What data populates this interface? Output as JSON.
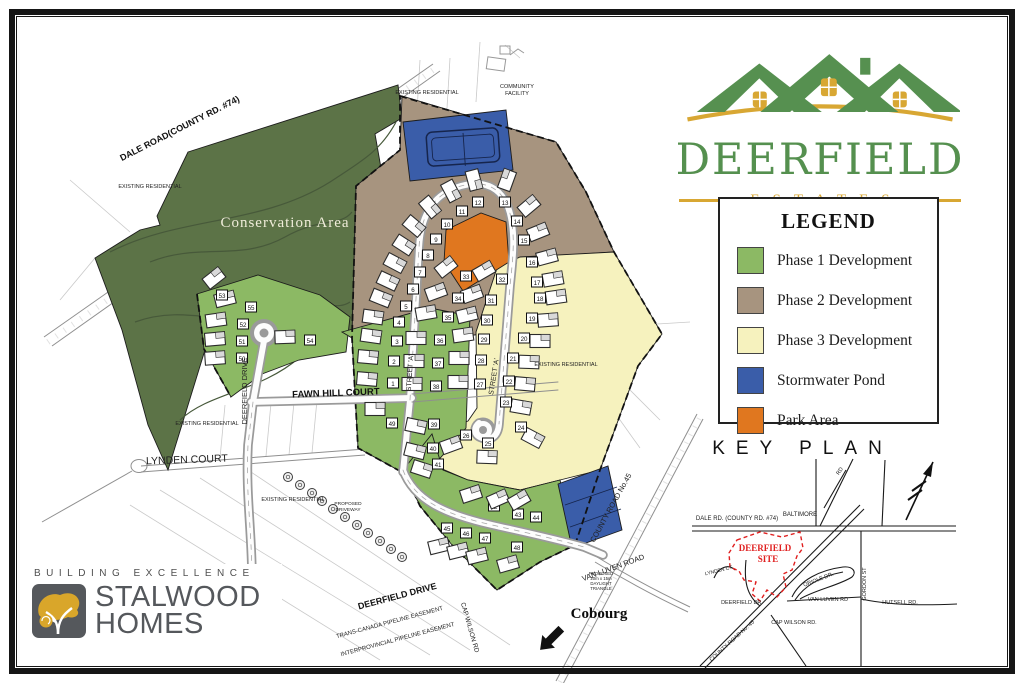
{
  "branding": {
    "name": "DEERFIELD",
    "tagline": "ESTATES"
  },
  "legend": {
    "title": "LEGEND",
    "items": [
      {
        "label": "Phase 1 Development",
        "color": "#8CB964"
      },
      {
        "label": "Phase 2 Development",
        "color": "#A7947F"
      },
      {
        "label": "Phase 3 Development",
        "color": "#F6F2BE"
      },
      {
        "label": "Stormwater Pond",
        "color": "#3A5DA9"
      },
      {
        "label": "Park Area",
        "color": "#E0771F"
      }
    ]
  },
  "key_plan": {
    "title": "KEY PLAN",
    "labels": [
      [
        "DALE RD. (COUNTY RD. #74)",
        737,
        520,
        0,
        6,
        "lbl"
      ],
      [
        "BALTIMORE",
        800,
        516,
        0,
        6,
        "lbl"
      ],
      [
        "RD",
        841,
        472,
        -55,
        5.5,
        "lbl"
      ],
      [
        "DEERFIELD",
        765,
        551,
        0,
        9,
        "red"
      ],
      [
        "SITE",
        768,
        562,
        0,
        9,
        "red"
      ],
      [
        "LYNDEN CT",
        719,
        572,
        -14,
        5,
        "lbl"
      ],
      [
        "DEERFIELD DR.",
        742,
        604,
        0,
        5.5,
        "lbl"
      ],
      [
        "COUNTY ROAD No. 45",
        733,
        642,
        -42,
        5.5,
        "lbl"
      ],
      [
        "CAP WILSON RD.",
        794,
        624,
        0,
        5.5,
        "lbl"
      ],
      [
        "VAN LUVEN  RD",
        828,
        601,
        0,
        5.5,
        "lbl"
      ],
      [
        "ORIOLE DR.",
        819,
        581,
        -21,
        5.5,
        "lbl"
      ],
      [
        "GORDON ST",
        866,
        584,
        -90,
        5.5,
        "lbl"
      ],
      [
        "HUTSELL RD.",
        900,
        604,
        0,
        5.5,
        "lbl"
      ]
    ]
  },
  "builder": {
    "tagline": "BUILDING EXCELLENCE",
    "name_line1": "STALWOOD",
    "name_line2": "HOMES"
  },
  "map": {
    "colors": {
      "phase1": "#8CB964",
      "phase2": "#A7947F",
      "phase3": "#F6F2BE",
      "pond": "#3A5DA9",
      "park": "#E0771F",
      "conservation": "#5C7347"
    },
    "labels": [
      [
        "DALE ROAD(COUNTY RD. #74)",
        181,
        131,
        -27,
        9,
        "lbl-b"
      ],
      [
        "Conservation Area",
        285,
        227,
        0,
        15,
        "cons"
      ],
      [
        "EXISTING RESIDENTIAL",
        150,
        188,
        0,
        5.5,
        "lbl"
      ],
      [
        "EXISTING RESIDENTIAL",
        427,
        94,
        0,
        5.5,
        "lbl"
      ],
      [
        "EXISTING RESIDENTIAL",
        566,
        366,
        0,
        5.5,
        "lbl"
      ],
      [
        "EXISTING RESIDENTIAL",
        207,
        425,
        0,
        5.5,
        "lbl"
      ],
      [
        "EXISTING RESIDENTIAL",
        293,
        501,
        0,
        5.5,
        "lbl"
      ],
      [
        "COMMUNITY",
        517,
        88,
        0,
        5.5,
        "lbl"
      ],
      [
        "FACILITY",
        517,
        95,
        0,
        5.5,
        "lbl"
      ],
      [
        "FAWN HILL COURT",
        336,
        396,
        -2,
        9.5,
        "lbl-b"
      ],
      [
        "LYNDEN COURT",
        187,
        463,
        -2,
        10.5,
        "lbl"
      ],
      [
        "DEERFIELD DRIVE",
        247,
        391,
        -90,
        7.5,
        "lbl"
      ],
      [
        "STREET 'A'",
        412,
        373,
        -86,
        7,
        "lbl"
      ],
      [
        "STREET 'A'",
        496,
        377,
        -81,
        7,
        "lbl"
      ],
      [
        "DEERFIELD DRIVE",
        398,
        599,
        -15,
        9,
        "lbl-b"
      ],
      [
        "TRANS-CANADA   PIPELINE   EASEMENT",
        390,
        624,
        -15,
        6,
        "lbl"
      ],
      [
        "INTERPROVINCIAL   PIPELINE   EASEMENT",
        398,
        641,
        -15,
        6,
        "lbl"
      ],
      [
        "CAP WILSON RD",
        468,
        628,
        74,
        6.5,
        "lbl"
      ],
      [
        "COUNTY ROAD No.45",
        613,
        509,
        -61,
        7.5,
        "lbl"
      ],
      [
        "VAN LUVEN ROAD",
        614,
        570,
        -20,
        7.5,
        "lbl"
      ],
      [
        "Cobourg",
        599,
        618,
        0,
        15,
        "cob"
      ],
      [
        "PROPOSED",
        348,
        505,
        0,
        4.8,
        "lbl"
      ],
      [
        "DRIVEWAY",
        348,
        511,
        0,
        4.8,
        "lbl"
      ],
      [
        "PROPOSED",
        601,
        575,
        0,
        4.3,
        "lbl"
      ],
      [
        "20m x 15m",
        601,
        580,
        0,
        4.3,
        "lbl"
      ],
      [
        "DAYLIGHT",
        601,
        585,
        0,
        4.3,
        "lbl"
      ],
      [
        "TRIANGLE",
        601,
        590,
        0,
        4.3,
        "lbl"
      ]
    ],
    "lots": [
      [
        1,
        393,
        383,
        -26,
        -4,
        5
      ],
      [
        2,
        394,
        361,
        -26,
        -4,
        5
      ],
      [
        3,
        397,
        341,
        -26,
        -5,
        8
      ],
      [
        4,
        399,
        322,
        -26,
        -5,
        8
      ],
      [
        5,
        406,
        306,
        -25,
        -8,
        22
      ],
      [
        6,
        413,
        289,
        -25,
        -8,
        25
      ],
      [
        7,
        420,
        272,
        -25,
        -9,
        28
      ],
      [
        8,
        428,
        255,
        -24,
        -10,
        33
      ],
      [
        9,
        436,
        239,
        -22,
        -13,
        40
      ],
      [
        10,
        447,
        224,
        -17,
        -17,
        50
      ],
      [
        11,
        462,
        211,
        -11,
        -20,
        62
      ],
      [
        12,
        478,
        202,
        -4,
        -22,
        75
      ],
      [
        13,
        505,
        202,
        2,
        -22,
        -70
      ],
      [
        14,
        517,
        221,
        12,
        -15,
        -40
      ],
      [
        15,
        524,
        240,
        14,
        -8,
        -22
      ],
      [
        16,
        532,
        262,
        15,
        -5,
        -15
      ],
      [
        17,
        537,
        282,
        16,
        -3,
        -10
      ],
      [
        18,
        540,
        298,
        16,
        -1,
        -8
      ],
      [
        19,
        532,
        318,
        16,
        2,
        -4
      ],
      [
        20,
        524,
        338,
        16,
        3,
        0
      ],
      [
        21,
        513,
        358,
        16,
        4,
        2
      ],
      [
        22,
        509,
        381,
        16,
        3,
        5
      ],
      [
        23,
        506,
        402,
        15,
        5,
        10
      ],
      [
        24,
        521,
        427,
        12,
        11,
        28
      ],
      [
        25,
        488,
        443,
        -1,
        14,
        2
      ],
      [
        26,
        466,
        435,
        -15,
        10,
        -20
      ],
      [
        27,
        480,
        384,
        -22,
        -2,
        0
      ],
      [
        28,
        481,
        360,
        -22,
        -2,
        0
      ],
      [
        29,
        484,
        339,
        -21,
        -4,
        -8
      ],
      [
        30,
        487,
        320,
        -20,
        -5,
        -14
      ],
      [
        31,
        491,
        300,
        -19,
        -6,
        -20
      ],
      [
        32,
        502,
        279,
        -18,
        -8,
        -30
      ],
      [
        33,
        466,
        276,
        -20,
        -9,
        -38
      ],
      [
        34,
        458,
        298,
        -22,
        -6,
        -20
      ],
      [
        35,
        448,
        317,
        -22,
        -4,
        -10
      ],
      [
        36,
        440,
        340,
        -24,
        -2,
        0
      ],
      [
        37,
        438,
        363,
        -24,
        -2,
        0
      ],
      [
        38,
        436,
        386,
        -24,
        -2,
        0
      ],
      [
        39,
        434,
        424,
        -18,
        2,
        12
      ],
      [
        40,
        433,
        448,
        -18,
        3,
        14
      ],
      [
        41,
        438,
        464,
        -16,
        5,
        18
      ],
      [
        42,
        494,
        506,
        -23,
        -12,
        -18
      ],
      [
        43,
        518,
        514,
        -20,
        -15,
        -24
      ],
      [
        44,
        536,
        517,
        -17,
        -17,
        -30
      ],
      [
        45,
        447,
        528,
        -8,
        18,
        -14
      ],
      [
        46,
        466,
        533,
        -8,
        18,
        -14
      ],
      [
        47,
        485,
        538,
        -8,
        18,
        -14
      ],
      [
        48,
        517,
        547,
        -9,
        17,
        -16
      ],
      [
        49,
        392,
        423,
        -17,
        -14,
        0
      ],
      [
        50,
        242,
        358,
        -27,
        0,
        -4
      ],
      [
        51,
        242,
        341,
        -27,
        -2,
        -5
      ],
      [
        52,
        243,
        324,
        -27,
        -4,
        -8
      ],
      [
        55,
        251,
        307,
        -26,
        -8,
        -14
      ],
      [
        53,
        222,
        295,
        -8,
        -17,
        -38
      ],
      [
        54,
        310,
        340,
        -25,
        -3,
        -2
      ]
    ],
    "trees": [
      [
        288,
        477
      ],
      [
        300,
        485
      ],
      [
        312,
        493
      ],
      [
        322,
        501
      ],
      [
        333,
        509
      ],
      [
        345,
        517
      ],
      [
        357,
        525
      ],
      [
        368,
        533
      ],
      [
        380,
        541
      ],
      [
        391,
        549
      ],
      [
        402,
        557
      ]
    ]
  }
}
